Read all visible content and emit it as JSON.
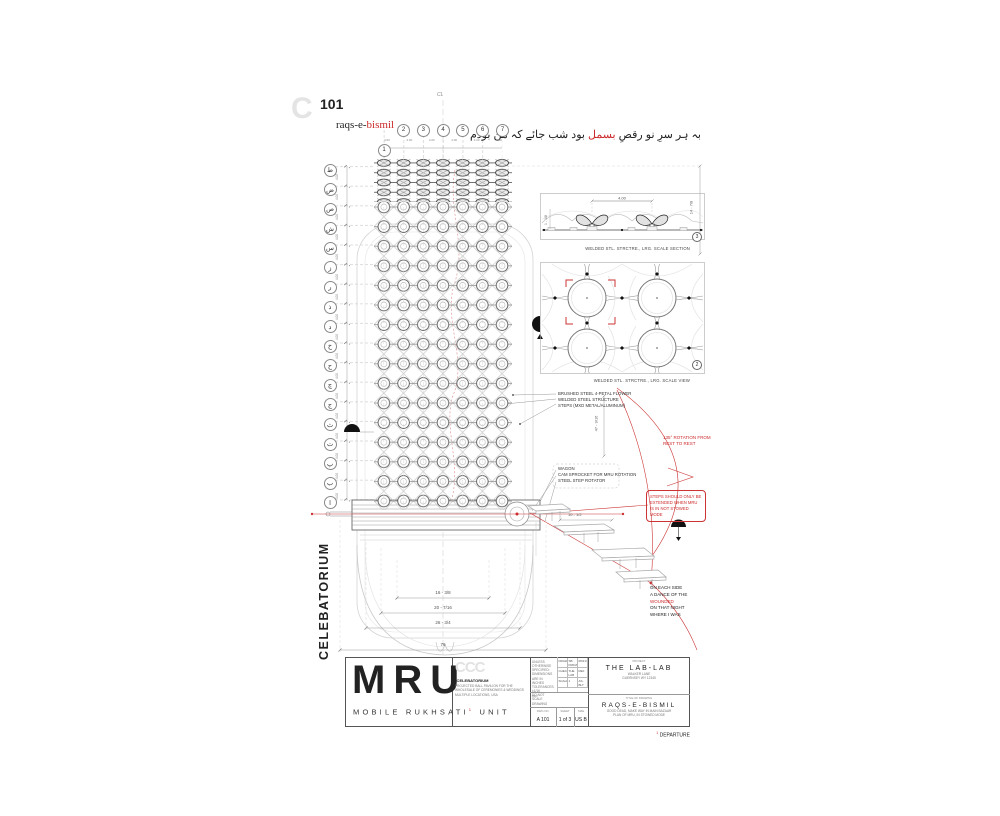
{
  "page": {
    "ghost_letter": "C",
    "sheet_no": "101",
    "centerline": "CL"
  },
  "header": {
    "raqs_black": "raqs-e-",
    "raqs_red": "bismil",
    "urdu_a": "بہ ہر سرِ نو رقصِ",
    "urdu_red": "بسمل",
    "urdu_b": "بود شب جائے کہ من بودم"
  },
  "grid": {
    "col_first": "1",
    "cols": [
      "2",
      "3",
      "4",
      "5",
      "6",
      "7"
    ],
    "rows": [
      "ط",
      "ض",
      "ص",
      "ش",
      "س",
      "ز",
      "ر",
      "ذ",
      "د",
      "خ",
      "ح",
      "چ",
      "ج",
      "ث",
      "ت",
      "پ",
      "ب",
      "ا"
    ],
    "row_dims": [
      "4.00",
      "4.00",
      "4.00",
      "4.00",
      "4.00",
      "4.00",
      "4.00",
      "4.00",
      "4.00",
      "4.00",
      "4.00",
      "4.00",
      "4.00",
      "4.00",
      "4.00",
      "4.00",
      "4.00"
    ],
    "col_dims": [
      "4.00",
      "4.00",
      "4.00",
      "4.00",
      "4.00",
      "4.00"
    ]
  },
  "details": {
    "d1_caption": "WELDED STL. STRCTRE., LRG. SCALE SECTION",
    "d1_ref": "3",
    "d1_dim": "4.00",
    "d1_left_dim": "1 - 1/8",
    "d2_caption": "WELDED STL. STRCTRE., LRG. SCALE VIEW",
    "d2_ref": "2"
  },
  "ann": {
    "materials": [
      "BRUSHED STEEL 4-PETAL FLOWER",
      "WELDED STEEL STRUCTURE",
      "STEPS (MXD METAL/ALUMINUM)"
    ],
    "mech": [
      "WAGON",
      "CAM SPROCKET FOR MRU ROTATION",
      "STEEL STEP ROTATOR"
    ],
    "rot_note": "135° ROTATION FROM REST TO REST",
    "steps_note": "STEPS SHOULD ONLY BE EXTENDED WHEN MRU IS IN NOT STOWED MODE",
    "poem1": "ON EACH SIDE",
    "poem2a": "A DANCE OF THE ",
    "poem2b": "WOUNDED",
    "poem3": "ON THAT NIGHT",
    "poem4": "WHERE I WAS"
  },
  "dims": {
    "h_right": "47 - 9/16",
    "tr": "14 - 7/8",
    "steps": "10 - 1/2",
    "b1": "16 - 3/8",
    "b2": "20 - 7/16",
    "b3": "26 - 3/4",
    "b4": "76"
  },
  "side_title": "CELEBATORIUM",
  "tb": {
    "logo": "MRU",
    "sub_a": "MOBILE RUKHSATI",
    "fn": "1",
    "sub_b": "UNIT",
    "ghost": "CCC",
    "org": "*CELEBATORIUM",
    "org1": "PROJECTED BALL PAVILION FOR THE WHOLESALE OF CEREMONIES & WEDDINGS",
    "org2": "MULTIPLE LOCATIONS, USA",
    "tol": [
      "UNLESS OTHERWISE SPECIFIED:",
      "DIMENSIONS ARE IN INCHES",
      "TOLERANCES: ±1/16",
      "DO NOT SCALE DRAWING"
    ],
    "rows": [
      {
        "l": "DRAWN",
        "v": "SB FRIDAY",
        "d": "08/21/2043"
      },
      {
        "l": "CHECKED",
        "v": "THE LAB",
        "d": "REF"
      },
      {
        "l": "SCALE",
        "v": "1",
        "d": "AS-BLT"
      }
    ],
    "rev_label": "REV",
    "proj_h": "PROJECT",
    "proj": "THE LAB-LAB",
    "addr1": "WALKER LANE",
    "addr2": "GUERNSEY WY 12345",
    "title_h": "TITLE OF DRAWING",
    "title": "RAQS-E-BISMIL",
    "t1": "GOOD DEAD, MAKE WAY IN MAIN BAZAAR",
    "t2": "PLAN OF MRU, IN STOWED MODE",
    "dwg_l": "DWG NO.",
    "dwg": "A 101",
    "sheet_l": "SHEET",
    "sheet": "1 of 3",
    "size_l": "SIZE",
    "size": "US B",
    "fn_text": "DEPARTURE"
  },
  "colors": {
    "accent_red": "#cc2a2a",
    "ghost_gray": "#e4e4e4"
  }
}
